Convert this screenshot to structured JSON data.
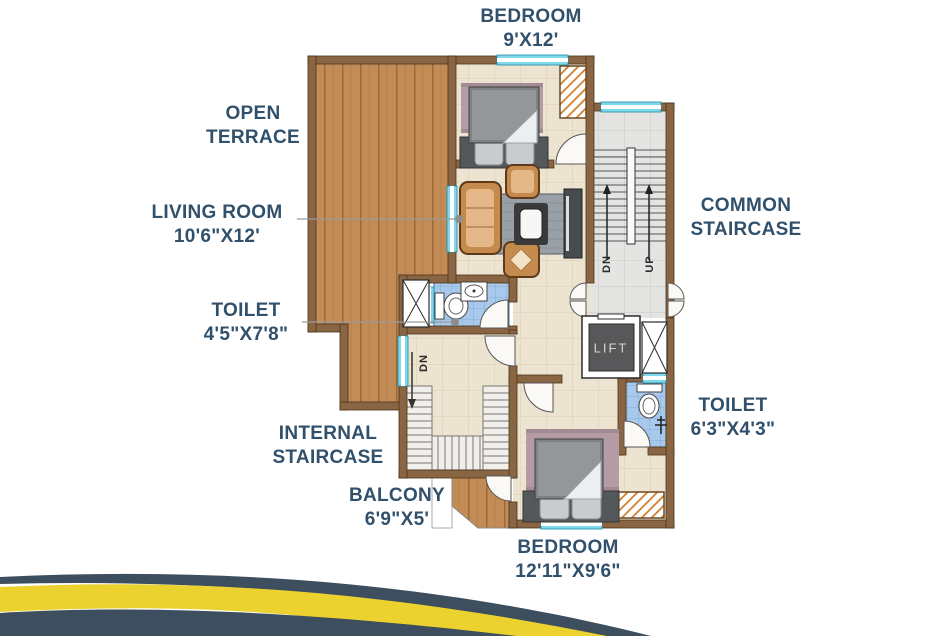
{
  "labels": {
    "bedroom_top": [
      "BEDROOM",
      "9'X12'"
    ],
    "open_terrace": [
      "OPEN",
      "TERRACE"
    ],
    "living_room": [
      "LIVING ROOM",
      "10'6\"X12'"
    ],
    "toilet_small": [
      "TOILET",
      "4'5\"X7'8\""
    ],
    "common_staircase": [
      "COMMON",
      "STAIRCASE"
    ],
    "toilet_attached": [
      "TOILET",
      "6'3\"X4'3\""
    ],
    "internal_staircase": [
      "INTERNAL",
      "STAIRCASE"
    ],
    "balcony": [
      "BALCONY",
      "6'9\"X5'"
    ],
    "bedroom_bottom": [
      "BEDROOM",
      "12'11\"X9'6\""
    ]
  },
  "markings": {
    "lift": "LIFT",
    "stair_down": "DN",
    "stair_up": "UP",
    "internal_down": "DN"
  },
  "colors": {
    "label_text": "#31506b",
    "wall": "#8a6544",
    "terrace_wood": "#c38c56",
    "floor_tile": "#ece3d0",
    "stair_floor": "#e4e4e2",
    "toilet_tile": "#a9c9ec",
    "window": "#b9ecf6",
    "swoosh_yellow": "#ecd22f",
    "swoosh_navy": "#3d4e5e"
  }
}
